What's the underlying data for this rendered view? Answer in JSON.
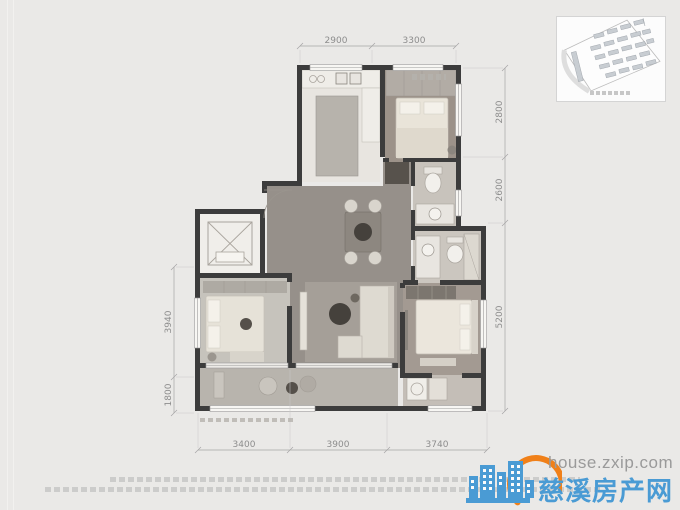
{
  "page": {
    "background": "#eae9e7"
  },
  "floor_plan": {
    "dims_top": [
      "2900",
      "3300"
    ],
    "dims_right": [
      "2800",
      "2600",
      "5200"
    ],
    "dims_left": [
      "3940",
      "1800"
    ],
    "dims_bottom": [
      "3400",
      "3900",
      "3740"
    ]
  },
  "watermark": {
    "url": "house.zxip.com",
    "site_name": "慈溪房产网",
    "brand_blue": "#4a9bd4",
    "brand_orange": "#f08019"
  }
}
